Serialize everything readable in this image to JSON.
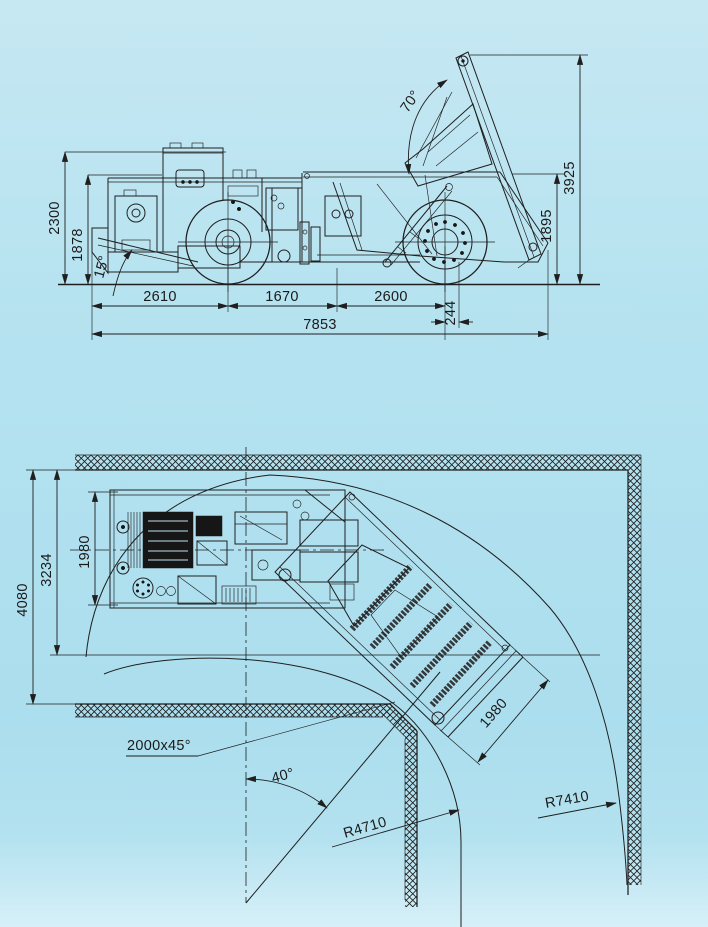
{
  "drawing": {
    "side_view": {
      "overall_height": "2300",
      "canopy_height": "1878",
      "approach_angle": "15°",
      "front_section_length": "2610",
      "middle_section_length": "1670",
      "rear_section_length": "2600",
      "overall_length": "7853",
      "axle_offset": "244",
      "body_rear_height": "1895",
      "tipping_height": "3925",
      "tipping_angle": "70°"
    },
    "plan_view": {
      "tunnel_width": "4080",
      "turning_clearance_width": "3234",
      "machine_width": "1980",
      "body_width": "1980",
      "corner_chamfer": "2000x45°",
      "articulation_angle": "40°",
      "inner_turning_radius": "R4710",
      "outer_turning_radius": "R7410"
    },
    "colors": {
      "background_top": "#c6e8f3",
      "background_bottom": "#abdeee",
      "line": "#1f1f1f"
    }
  }
}
